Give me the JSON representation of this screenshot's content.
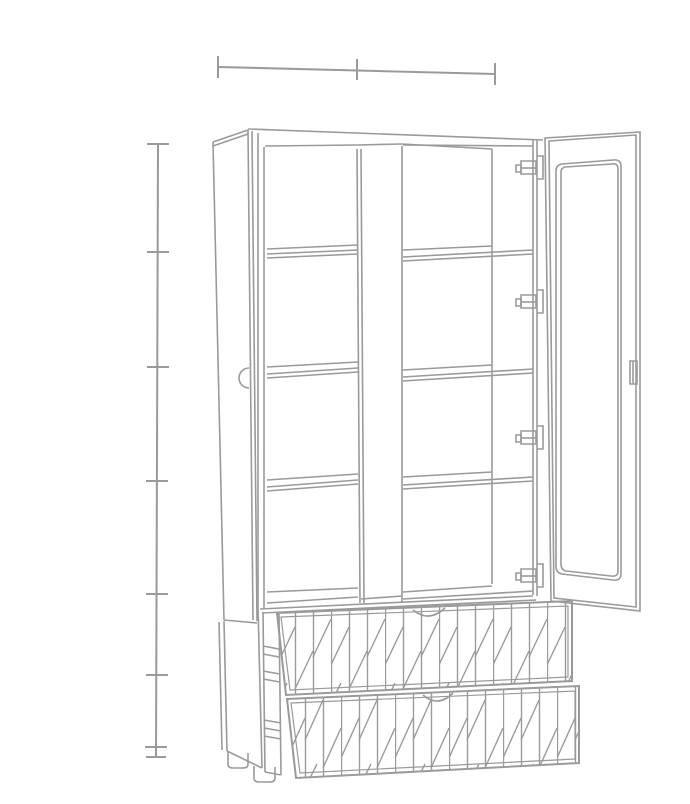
{
  "meta": {
    "description": "Technical outline drawing of a tall two-door display cabinet shown with both doors open, eight shelf compartments, four visible hinges, an edge pull handle, and two open lower drawers with geometric strip-pattern fronts standing on small feet",
    "drawing_style": "gray single-weight line art on white"
  },
  "colors": {
    "background": "#ffffff",
    "line": "#9a9a9a"
  },
  "dimensions": {
    "top_dimension_line": {
      "tick_count": 3
    },
    "left_dimension_line": {
      "tick_count": 8,
      "tick_y_px": [
        144,
        252,
        367,
        481,
        594,
        675,
        747,
        757
      ]
    }
  },
  "cabinet": {
    "doors": 2,
    "door_state": "open",
    "columns": 2,
    "shelves_per_column": 3,
    "compartments": 8,
    "hinges_visible": 4,
    "handles_visible": 2,
    "drawers": 2,
    "drawer_front_pattern": "vertical strips with staggered diagonals",
    "feet_visible": 2
  }
}
